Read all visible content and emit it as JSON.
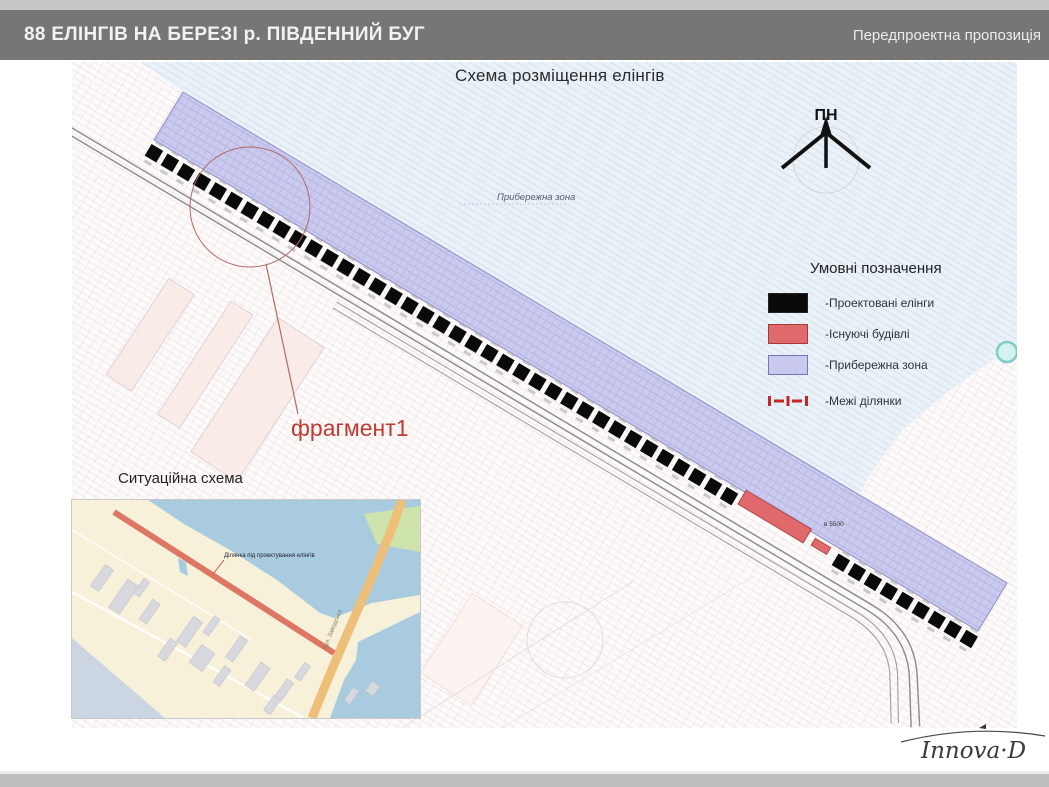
{
  "header": {
    "title": "88 ЕЛІНГІВ НА БЕРЕЗІ р. ПІВДЕННИЙ БУГ",
    "subtitle": "Передпроектна пропозиція"
  },
  "map": {
    "title": "Схема розміщення елінгів",
    "north_label": "ПН",
    "coastal_zone_label": "Прибережна зона",
    "fragment_label": "фрагмент1",
    "dimension_label": "в 5500"
  },
  "legend": {
    "title": "Умовні позначення",
    "items": [
      {
        "label": "-Проектовані елінги",
        "color": "#0a0a0a"
      },
      {
        "label": "-Існуючі будівлі",
        "color": "#e0696b"
      },
      {
        "label": "-Прибережна зона",
        "color": "#c9c9ef"
      },
      {
        "label": "-Межі ділянки",
        "color": "#c42727"
      }
    ]
  },
  "inset": {
    "title": "Ситуаційна схема",
    "site_label": "Ділянка під проектування елінгів",
    "road_label": "вул. Заводська"
  },
  "footer": {
    "logo": "Innova·D"
  },
  "colors": {
    "header_bg": "#767676",
    "water": "#eaf2f8",
    "coastal_band": "#cacaef",
    "existing_building": "#e0696b",
    "fragment_red": "#bf3a30"
  }
}
